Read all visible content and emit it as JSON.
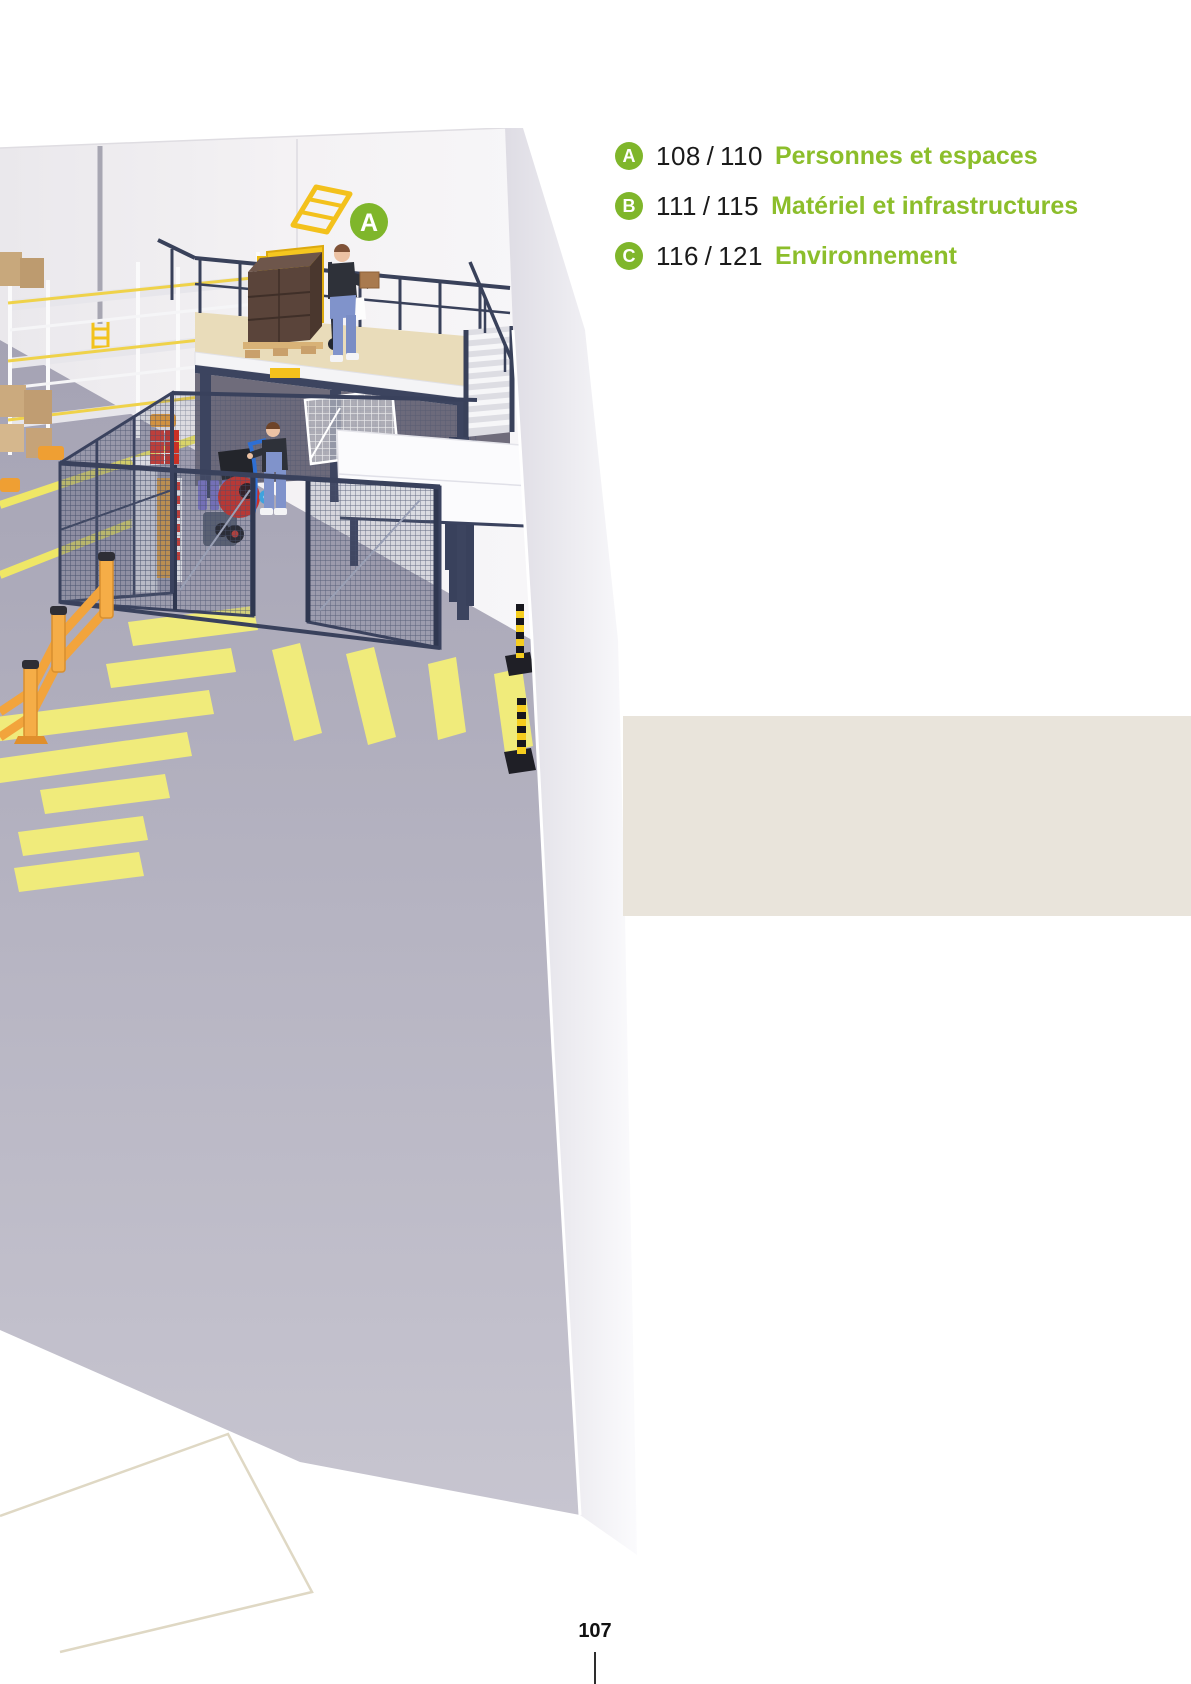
{
  "legend": {
    "items": [
      {
        "badge": "A",
        "pages": "108 / 110",
        "label": "Personnes et espaces"
      },
      {
        "badge": "B",
        "pages": "111 / 115",
        "label": "Matériel et infrastructures"
      },
      {
        "badge": "C",
        "pages": "116 / 121",
        "label": "Environnement"
      }
    ]
  },
  "illustration": {
    "marker_badge": "A",
    "description": "Vue 3D isométrique d'un entrepôt : mezzanine avec garde-corps et barrière écluse jaune, opérateur portant un carton, escalier, enclos grillagé avec opérateur et diable, rayonnage à palettes, barrières orange, passages piétons jaunes, poteaux noir et jaune"
  },
  "footer": {
    "page_number": "107"
  },
  "colors": {
    "accent_green": "#8CBE2B",
    "badge_green": "#7FB62B",
    "side_band_beige": "#E9E4DB",
    "text_black": "#1A1A1A",
    "floor_gray": "#ACAABA",
    "safety_yellow": "#F0EB7B",
    "gate_yellow": "#F6C71F",
    "barrier_orange": "#F2A43C",
    "steel_navy": "#3C445F",
    "mezzanine_beige": "#E9DCBA",
    "wall_white": "#F2F0F2"
  }
}
